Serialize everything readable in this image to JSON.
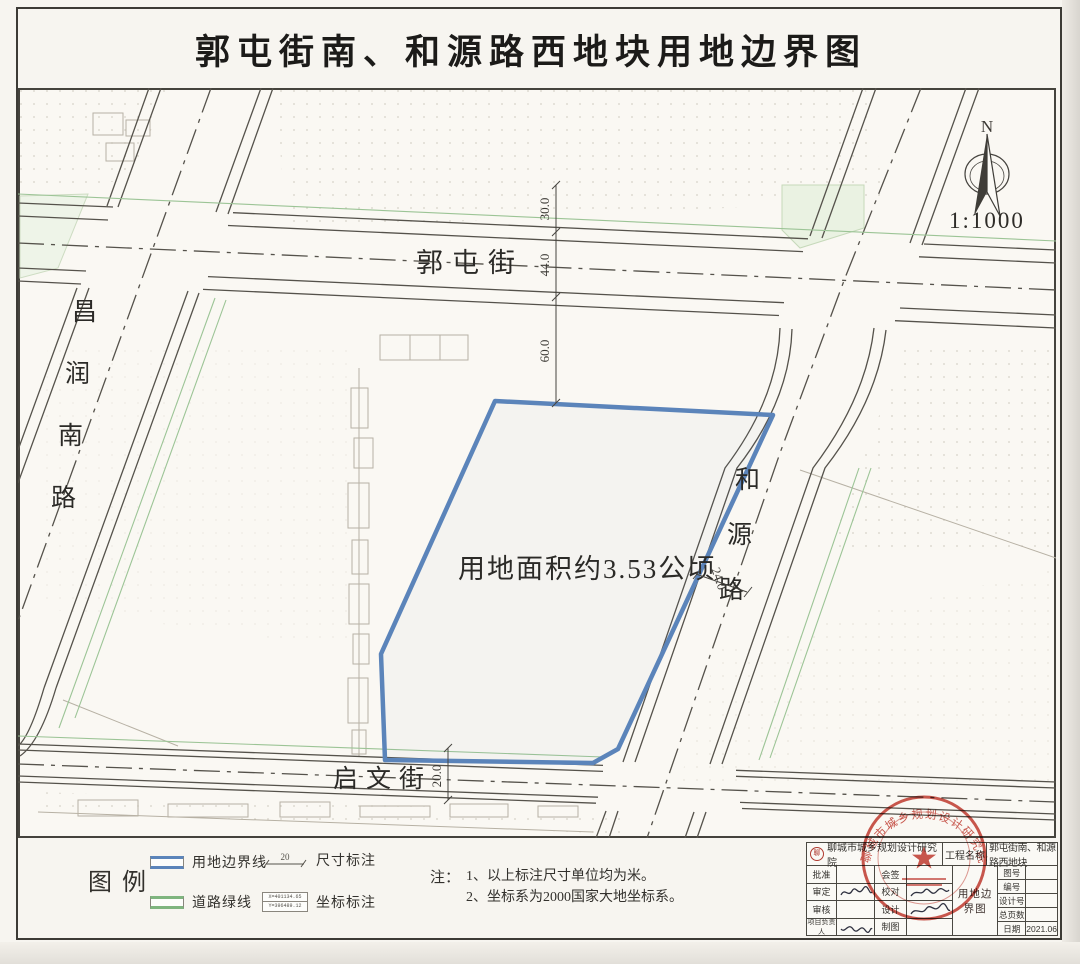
{
  "title": "郭屯街南、和源路西地块用地边界图",
  "map": {
    "north_label": "N",
    "scale_text": "1:1000",
    "roads": {
      "north_street": "郭屯街",
      "south_street": "启文街",
      "west_road_chars": [
        "昌",
        "润",
        "南",
        "路"
      ],
      "east_road_chars": [
        "和",
        "源",
        "路"
      ]
    },
    "parcel_area_label": "用地面积约3.53公顷",
    "dimensions": {
      "d30": "30.0",
      "d44": "44.0",
      "d60": "60.0",
      "d24": "24.0",
      "d20": "20.0"
    }
  },
  "legend": {
    "title": "图例",
    "boundary_label": "用地边界线",
    "greenline_label": "道路绿线",
    "dim_label": "尺寸标注",
    "dim_sample": "20",
    "coord_label": "坐标标注",
    "coord_x": "X=401134.65",
    "coord_y": "Y=396489.12",
    "notes_label": "注：",
    "note1": "1、以上标注尺寸单位均为米。",
    "note2": "2、坐标系为2000国家大地坐标系。"
  },
  "titleblock": {
    "institute": "聊城市城乡规划设计研究院",
    "project_label": "工程名称",
    "project_name": "郭屯街南、和源路西地块",
    "drawing_name": "用地边界图",
    "left_rows": [
      [
        "批准",
        "会签"
      ],
      [
        "审定",
        "校对"
      ],
      [
        "审核",
        "设计"
      ],
      [
        "项目负责人",
        "制图"
      ]
    ],
    "right_rows": [
      [
        "图号",
        ""
      ],
      [
        "编号",
        ""
      ],
      [
        "设计号",
        ""
      ],
      [
        "总页数",
        ""
      ],
      [
        "日期",
        "2021.06"
      ]
    ],
    "seal_text": "聊城市城乡规划设计研究院"
  },
  "colors": {
    "boundary_blue": "#5b84ba",
    "road_green": "#7fb57f",
    "seal_red": "#c23a30",
    "map_ink": "#55524b"
  }
}
